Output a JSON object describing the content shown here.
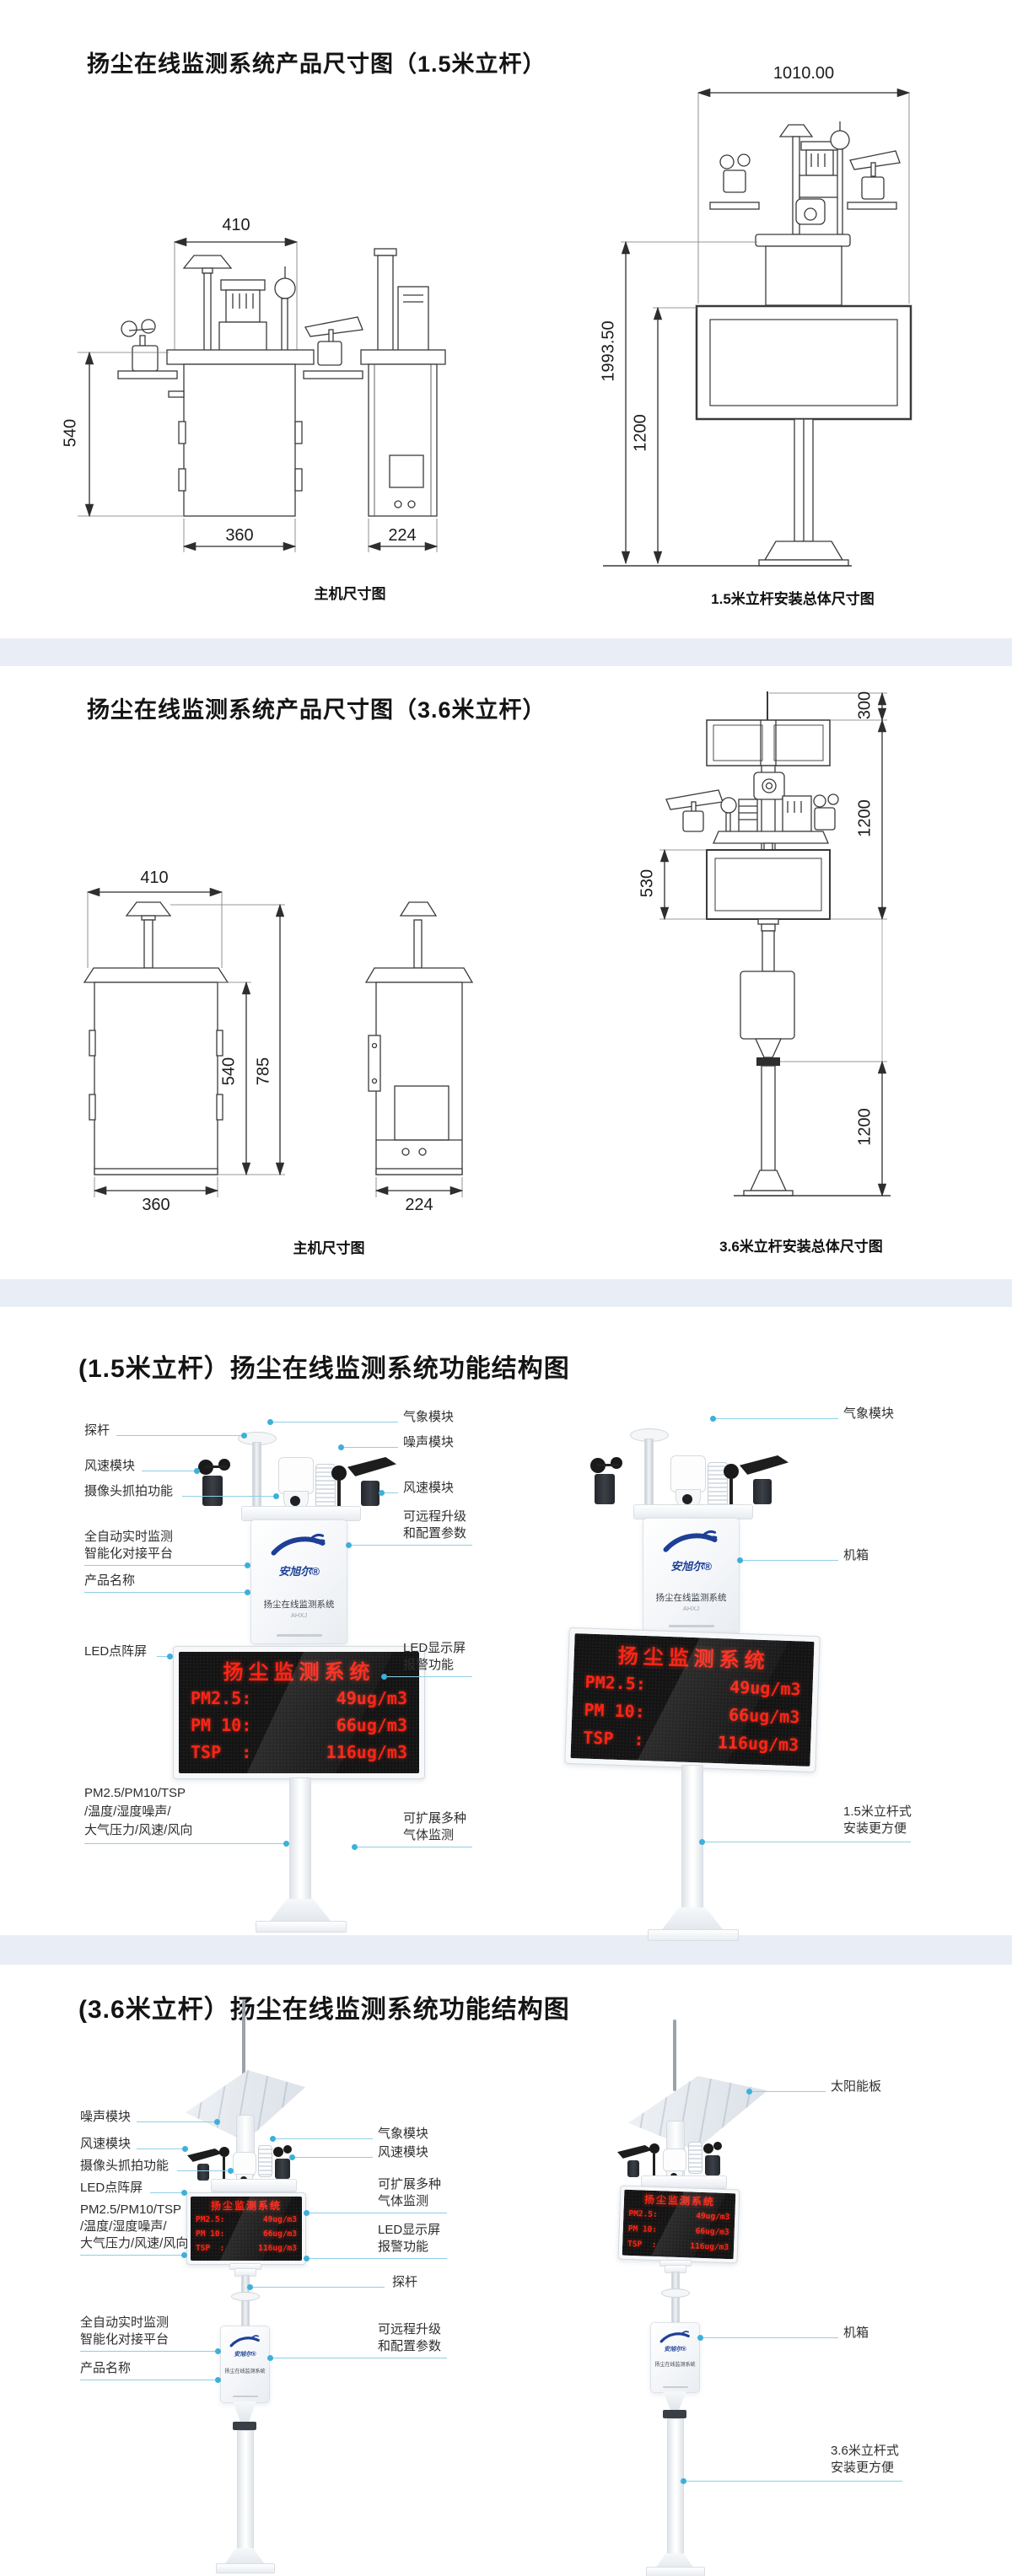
{
  "colors": {
    "band": "#e9eef6",
    "callout_line": "#8fcfe6",
    "callout_dot": "#3db0da",
    "led_red": "#ff2416",
    "logo_blue": "#1d3f96",
    "drawing_line": "#3a3a3a"
  },
  "device": {
    "brand": "安旭尔®",
    "product": "扬尘在线监测系统",
    "model": "AHXJ"
  },
  "led": {
    "title": "扬尘监测系统",
    "rows": [
      {
        "k": "PM2.5:",
        "v": "49ug/m3"
      },
      {
        "k": "PM 10:",
        "v": "66ug/m3"
      },
      {
        "k": "TSP  :",
        "v": "116ug/m3"
      }
    ]
  },
  "s1": {
    "title": "扬尘在线监测系统产品尺寸图（1.5米立杆）",
    "front": {
      "top": "410",
      "left": "540",
      "bottom": "360"
    },
    "side": {
      "bottom": "224"
    },
    "caption_main": "主机尺寸图",
    "overall": {
      "width": "1010.00",
      "total": "1993.50",
      "pole": "1200",
      "caption": "1.5米立杆安装总体尺寸图"
    }
  },
  "s2": {
    "title": "扬尘在线监测系统产品尺寸图（3.6米立杆）",
    "front": {
      "top": "410",
      "body": "540",
      "total": "785",
      "bottom": "360"
    },
    "side": {
      "bottom": "224"
    },
    "caption_main": "主机尺寸图",
    "overall": {
      "top": "300",
      "upper": "1200",
      "screen": "530",
      "lower": "1200",
      "caption": "3.6米立杆安装总体尺寸图"
    }
  },
  "s3": {
    "title": "(1.5米立杆）扬尘在线监测系统功能结构图",
    "labels": {
      "probe": "探杆",
      "wind": "风速模块",
      "camera": "摄像头抓拍功能",
      "auto1": "全自动实时监测",
      "auto2": "智能化对接平台",
      "product": "产品名称",
      "led_matrix": "LED点阵屏",
      "pm1": "PM2.5/PM10/TSP",
      "pm2": "/温度/湿度噪声/",
      "pm3": "大气压力/风速/风向",
      "weather": "气象模块",
      "noise": "噪声模块",
      "wind2": "风速模块",
      "remote1": "可远程升级",
      "remote2": "和配置参数",
      "led1": "LED显示屏",
      "led2": "报警功能",
      "gas1": "可扩展多种",
      "gas2": "气体监测",
      "weather_r": "气象模块",
      "cabinet": "机箱",
      "mount1": "1.5米立杆式",
      "mount2": "安装更方便"
    }
  },
  "s4": {
    "title": "(3.6米立杆）扬尘在线监测系统功能结构图",
    "labels": {
      "noise": "噪声模块",
      "wind": "风速模块",
      "camera": "摄像头抓拍功能",
      "led_matrix": "LED点阵屏",
      "pm1": "PM2.5/PM10/TSP",
      "pm2": "/温度/湿度噪声/",
      "pm3": "大气压力/风速/风向",
      "auto1": "全自动实时监测",
      "auto2": "智能化对接平台",
      "product": "产品名称",
      "weather": "气象模块",
      "wind2": "风速模块",
      "gas1": "可扩展多种",
      "gas2": "气体监测",
      "led1": "LED显示屏",
      "led2": "报警功能",
      "probe": "探杆",
      "remote1": "可远程升级",
      "remote2": "和配置参数",
      "solar": "太阳能板",
      "cabinet": "机箱",
      "mount1": "3.6米立杆式",
      "mount2": "安装更方便"
    }
  }
}
